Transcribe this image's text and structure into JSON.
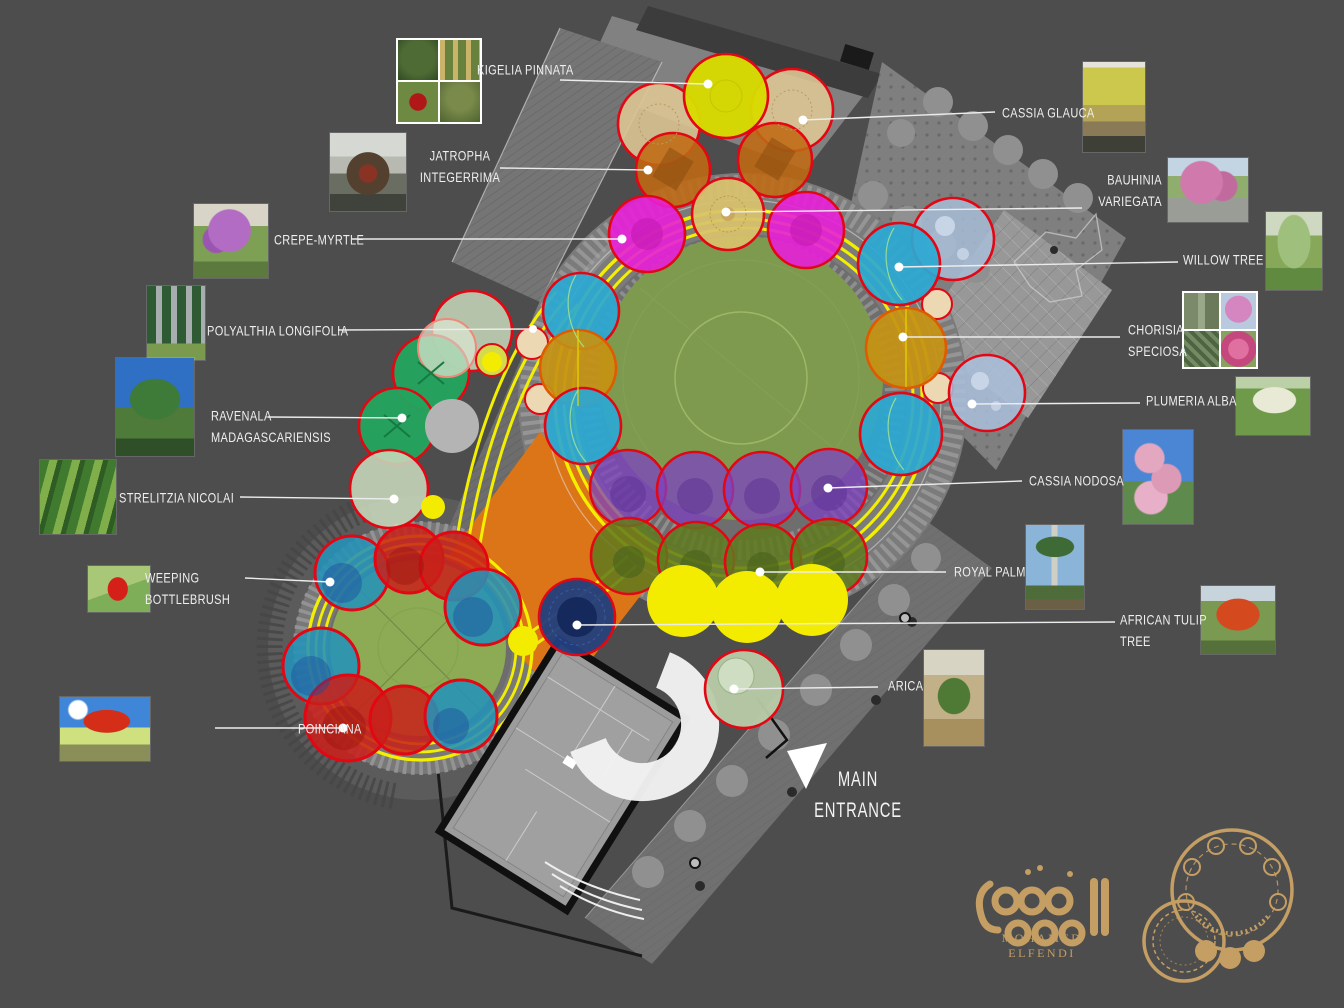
{
  "palette": {
    "background": "#4e4d4d",
    "leader_line": "#ededed",
    "track_yellow": "#f3ef00",
    "field_green": "#7d9a4f",
    "canopy_outline_red": "#e30613",
    "orange_plaza": "#dc7517",
    "logo_gold": "#c49e63",
    "building_outline": "#111111",
    "crescent_white": "#f2f2f2"
  },
  "species": [
    {
      "id": "kigelia-pinnata",
      "line1": "KIGELIA  PINNATA",
      "photo": "kigelia-collage-photo",
      "canopy_color": "#d8da00"
    },
    {
      "id": "cassia-glauca",
      "line1": "CASSIA  GLAUCA",
      "photo": "yellow-flowering-tree-photo",
      "canopy_color": "#dcc593"
    },
    {
      "id": "jatropha-integerrima",
      "line1": "JATROPHA",
      "line2": "INTEGERRIMA",
      "photo": "red-flowering-shrub-photo",
      "canopy_color": "#bf6a12"
    },
    {
      "id": "bauhinia-variegata",
      "line1": "BAUHINIA",
      "line2": "VARIEGATA",
      "photo": "pink-orchid-tree-photo",
      "canopy_color": "#d9c26d"
    },
    {
      "id": "crepe-myrtle",
      "line1": "CREPE-MYRTLE",
      "photo": "purple-flowering-tree-photo",
      "canopy_color": "#e81fd8"
    },
    {
      "id": "willow-tree",
      "line1": "WILLOW  TREE",
      "photo": "weeping-willow-photo",
      "canopy_color": "#2ba8d2"
    },
    {
      "id": "polyalthia-longifolia",
      "line1": "POLYALTHIA  LONGIFOLIA",
      "photo": "columnar-trees-photo",
      "canopy_color": "#c8d8bc"
    },
    {
      "id": "chorisia-speciosa",
      "line1": "CHORISIA",
      "line2": "SPECIOSA",
      "photo": "chorisia-collage-photo",
      "canopy_color": "#c59212"
    },
    {
      "id": "ravenala-madagascariensis",
      "line1": "RAVENALA",
      "line2": "MADAGASCARIENSIS",
      "photo": "travelers-palm-photo",
      "canopy_color": "#23a45e"
    },
    {
      "id": "plumeria-alba",
      "line1": "PLUMERIA  ALBA",
      "photo": "white-frangipani-photo",
      "canopy_color": "#a9c0dc"
    },
    {
      "id": "strelitzia-nicolai",
      "line1": "STRELITZIA  NICOLAI",
      "photo": "giant-bird-of-paradise-photo",
      "canopy_color": "#c8d8bc"
    },
    {
      "id": "cassia-nodosa",
      "line1": "CASSIA  NODOSA",
      "photo": "pink-shower-tree-photo",
      "canopy_color": "#7e42c2"
    },
    {
      "id": "weeping-bottlebrush",
      "line1": "WEEPING",
      "line2": "BOTTLEBRUSH",
      "photo": "red-bottlebrush-photo",
      "canopy_color": "#2492b8"
    },
    {
      "id": "royal-palm",
      "line1": "ROYAL  PALM",
      "photo": "royal-palms-photo",
      "canopy_color": "#5f7a1e"
    },
    {
      "id": "african-tulip-tree",
      "line1": "AFRICAN  TULIP",
      "line2": "TREE",
      "photo": "orange-flowering-tree-photo",
      "canopy_color": "#23407e"
    },
    {
      "id": "poinciana",
      "line1": "POINCIANA",
      "photo": "flame-tree-photo",
      "canopy_color": "#c8201a"
    },
    {
      "id": "arica",
      "line1": "ARICA",
      "photo": "nursery-palm-photo",
      "canopy_color": "#b8cba6"
    }
  ],
  "entrance": {
    "line1": "MAIN",
    "line2": "ENTRANCE"
  },
  "logo": {
    "designer": "MOHAMED ELFENDI",
    "mark": "arabic-calligraphy-and-plan-sketch"
  },
  "plan": {
    "areas": [
      "main-circular-plaza",
      "secondary-circular-plaza",
      "orange-square-plaza",
      "building-footprint",
      "main-entrance",
      "pedestrian-path",
      "lattice-court"
    ]
  }
}
